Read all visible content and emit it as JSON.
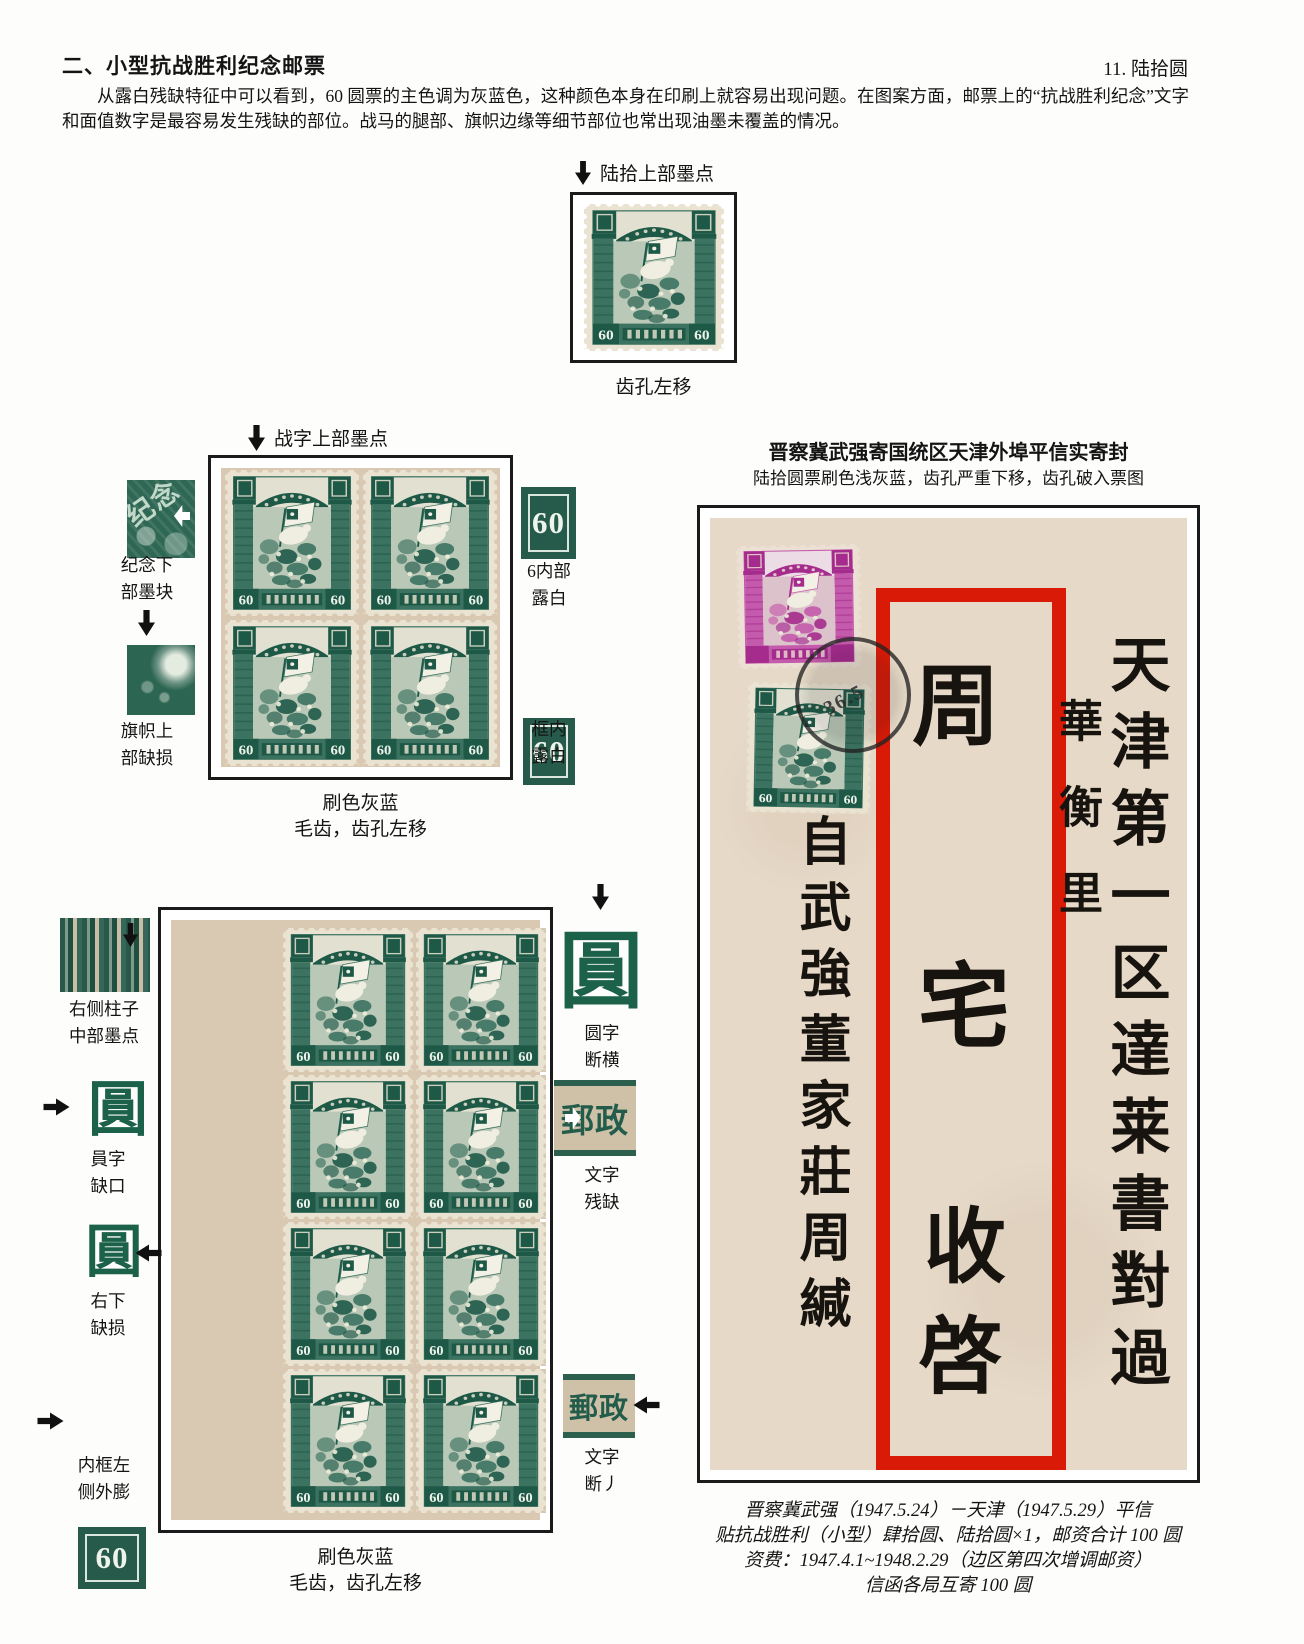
{
  "header": {
    "section_title": "二、小型抗战胜利纪念邮票",
    "page_label": "11. 陆拾圆",
    "intro": "从露白残缺特征中可以看到，60 圆票的主色调为灰蓝色，这种颜色本身在印刷上就容易出现问题。在图案方面，邮票上的“抗战胜利纪念”文字和面值数字是最容易发生残缺的部位。战马的腿部、旗帜边缘等细节部位也常出现油墨未覆盖的情况。"
  },
  "stamp_value": "60",
  "single_stamp": {
    "arrow_label": "陆拾上部墨点",
    "caption": "齿孔左移"
  },
  "block4": {
    "arrow_label": "战字上部墨点",
    "left_annotations": [
      {
        "lines": [
          "纪念下",
          "部墨块"
        ],
        "seal_text": "纪念"
      },
      {
        "lines": [
          "旗帜上",
          "部缺损"
        ]
      }
    ],
    "right_annotations": [
      {
        "lines": [
          "6内部",
          "露白"
        ]
      },
      {
        "lines": [
          "框内",
          "露白"
        ]
      }
    ],
    "caption_line1": "刷色灰蓝",
    "caption_line2": "毛齿，齿孔左移"
  },
  "cover": {
    "title": "晋察冀武强寄国统区天津外埠平信实寄封",
    "subtitle": "陆拾圆票刷色浅灰蓝，齿孔严重下移，齿孔破入票图",
    "postmark_date": "36.5",
    "address_column": "天津第一区達莱書對過",
    "lane_column": "華衡里",
    "addressee_chars": [
      "周",
      "宅",
      "收",
      "啓"
    ],
    "sender_column": "自武強董家莊周緘",
    "captions": [
      "晋察冀武强（1947.5.24）－天津（1947.5.29）平信",
      "贴抗战胜利（小型）肆拾圆、陆拾圆×1，邮资合计 100 圆",
      "资费：1947.4.1~1948.2.29（边区第四次增调邮资）",
      "信函各局互寄 100 圆"
    ]
  },
  "block8": {
    "left_annotations": [
      {
        "lines": [
          "右侧柱子",
          "中部墨点"
        ]
      },
      {
        "lines": [
          "員字",
          "缺口"
        ]
      },
      {
        "lines": [
          "右下",
          "缺损"
        ]
      },
      {
        "lines": [
          "内框左",
          "侧外膨"
        ]
      }
    ],
    "right_annotations": [
      {
        "lines": [
          "圆字",
          "断横"
        ]
      },
      {
        "lines": [
          "文字",
          "残缺"
        ]
      },
      {
        "lines": [
          "文字",
          "断丿"
        ]
      }
    ],
    "yuan_glyph": "圓",
    "post_glyph": "郵政",
    "caption_line1": "刷色灰蓝",
    "caption_line2": "毛齿，齿孔左移"
  },
  "colors": {
    "stamp_green_dark": "#1e5948",
    "stamp_green_mid": "#3c7260",
    "stamp_green_paper": "#ebe3d2",
    "stamp_green_center": "#e2e1d1",
    "stamp_magenta_dark": "#a52b8d",
    "stamp_magenta_mid": "#c45aab",
    "stamp_magenta_paper": "#ecdfd3",
    "stamp_magenta_center": "#ecdce5",
    "backing_tan": "#d9c9b2",
    "envelope_tan": "#e6d9c7",
    "frame_red": "#d81a07",
    "postmark_ink": "#2b2b2b",
    "arrow_black": "#111111"
  }
}
